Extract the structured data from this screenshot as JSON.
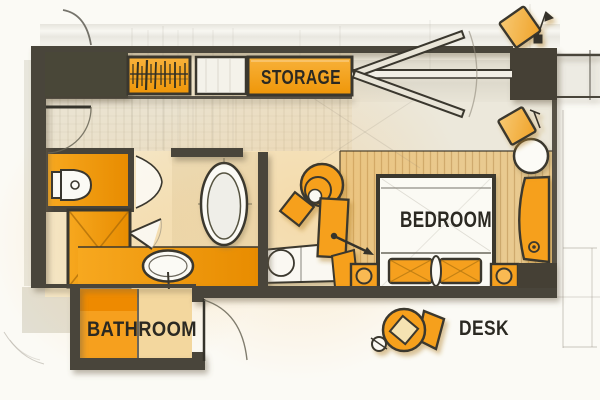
{
  "labels": {
    "storage": "STORAGE",
    "bedroom": "BEDROOM",
    "bathroom": "BATHROOM",
    "desk": "DESK"
  },
  "colors": {
    "accent_orange": "#F6A01E",
    "deep_orange": "#EE8C05",
    "wall_dark": "#48443A",
    "label_text": "#2B2922",
    "paper": "#FBFAF5",
    "floor_cream": "#F4E9CD",
    "floor_stripe": "#E9CA90"
  }
}
